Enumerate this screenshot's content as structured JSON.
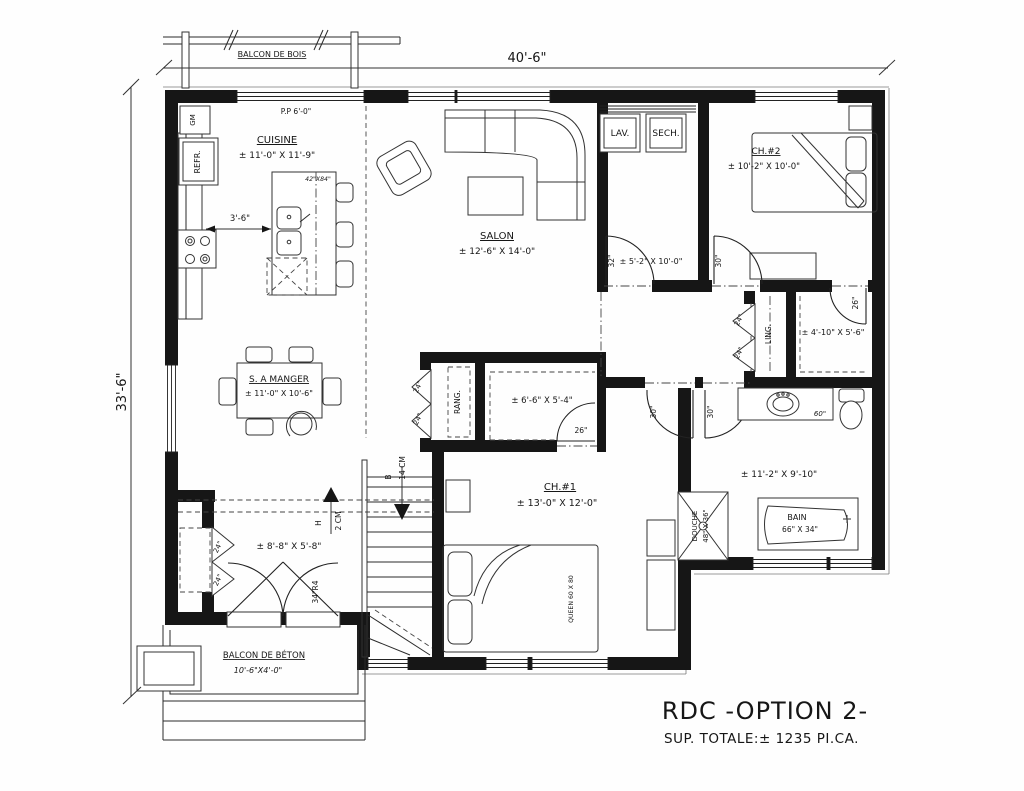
{
  "title": {
    "main": "RDC -OPTION 2-",
    "sub": "SUP. TOTALE:± 1235 PI.CA."
  },
  "dimensions": {
    "width": "40'-6\"",
    "height": "33'-6\""
  },
  "balconies": {
    "wood": {
      "name": "BALCON DE BOIS"
    },
    "concrete": {
      "name": "BALCON DE BÉTON",
      "size": "10'-6\"X4'-0\""
    }
  },
  "doors": {
    "d32": "32\"",
    "d30": "30\"",
    "d26": "26\"",
    "d24": "24\"",
    "front": "34\"R4"
  },
  "stairs": {
    "down_label": "B",
    "down_count": "14 CM",
    "up_label": "H",
    "up_count": "2 CM"
  },
  "rooms": {
    "cuisine": {
      "name": "CUISINE",
      "size": "± 11'-0\" X 11'-9\"",
      "island": "42\"X84\"",
      "clearance": "3'-6\"",
      "pantry": "GM",
      "fridge": "REFR.",
      "window": "P.P 6'-0\""
    },
    "salon": {
      "name": "SALON",
      "size": "± 12'-6\" X 14'-0\""
    },
    "laundry": {
      "washer": "LAV.",
      "dryer": "SECH.",
      "size": "± 5'-2\" X 10'-0\""
    },
    "ch2": {
      "name": "CH.#2",
      "size": "± 10'-2\" X 10'-0\""
    },
    "walkin2": {
      "size": "± 4'-10\" X 5'-6\""
    },
    "ling": {
      "name": "LING."
    },
    "dining": {
      "name": "S. A MANGER",
      "size": "± 11'-0\" X 10'-6\""
    },
    "rang": {
      "name": "RANG."
    },
    "walkin1": {
      "size": "± 6'-6\" X 5'-4\""
    },
    "ch1": {
      "name": "CH.#1",
      "size": "± 13'-0\" X 12'-0\"",
      "bed": "QUEEN 60 X 80"
    },
    "bath": {
      "size": "± 11'-2\" X 9'-10\"",
      "vanity": "60\"",
      "shower_name": "DOUCHE",
      "shower_size": "48\" X 36\"",
      "tub_name": "BAIN",
      "tub_size": "66\" X 34\""
    },
    "entry": {
      "size": "± 8'-8\" X 5'-8\""
    }
  }
}
